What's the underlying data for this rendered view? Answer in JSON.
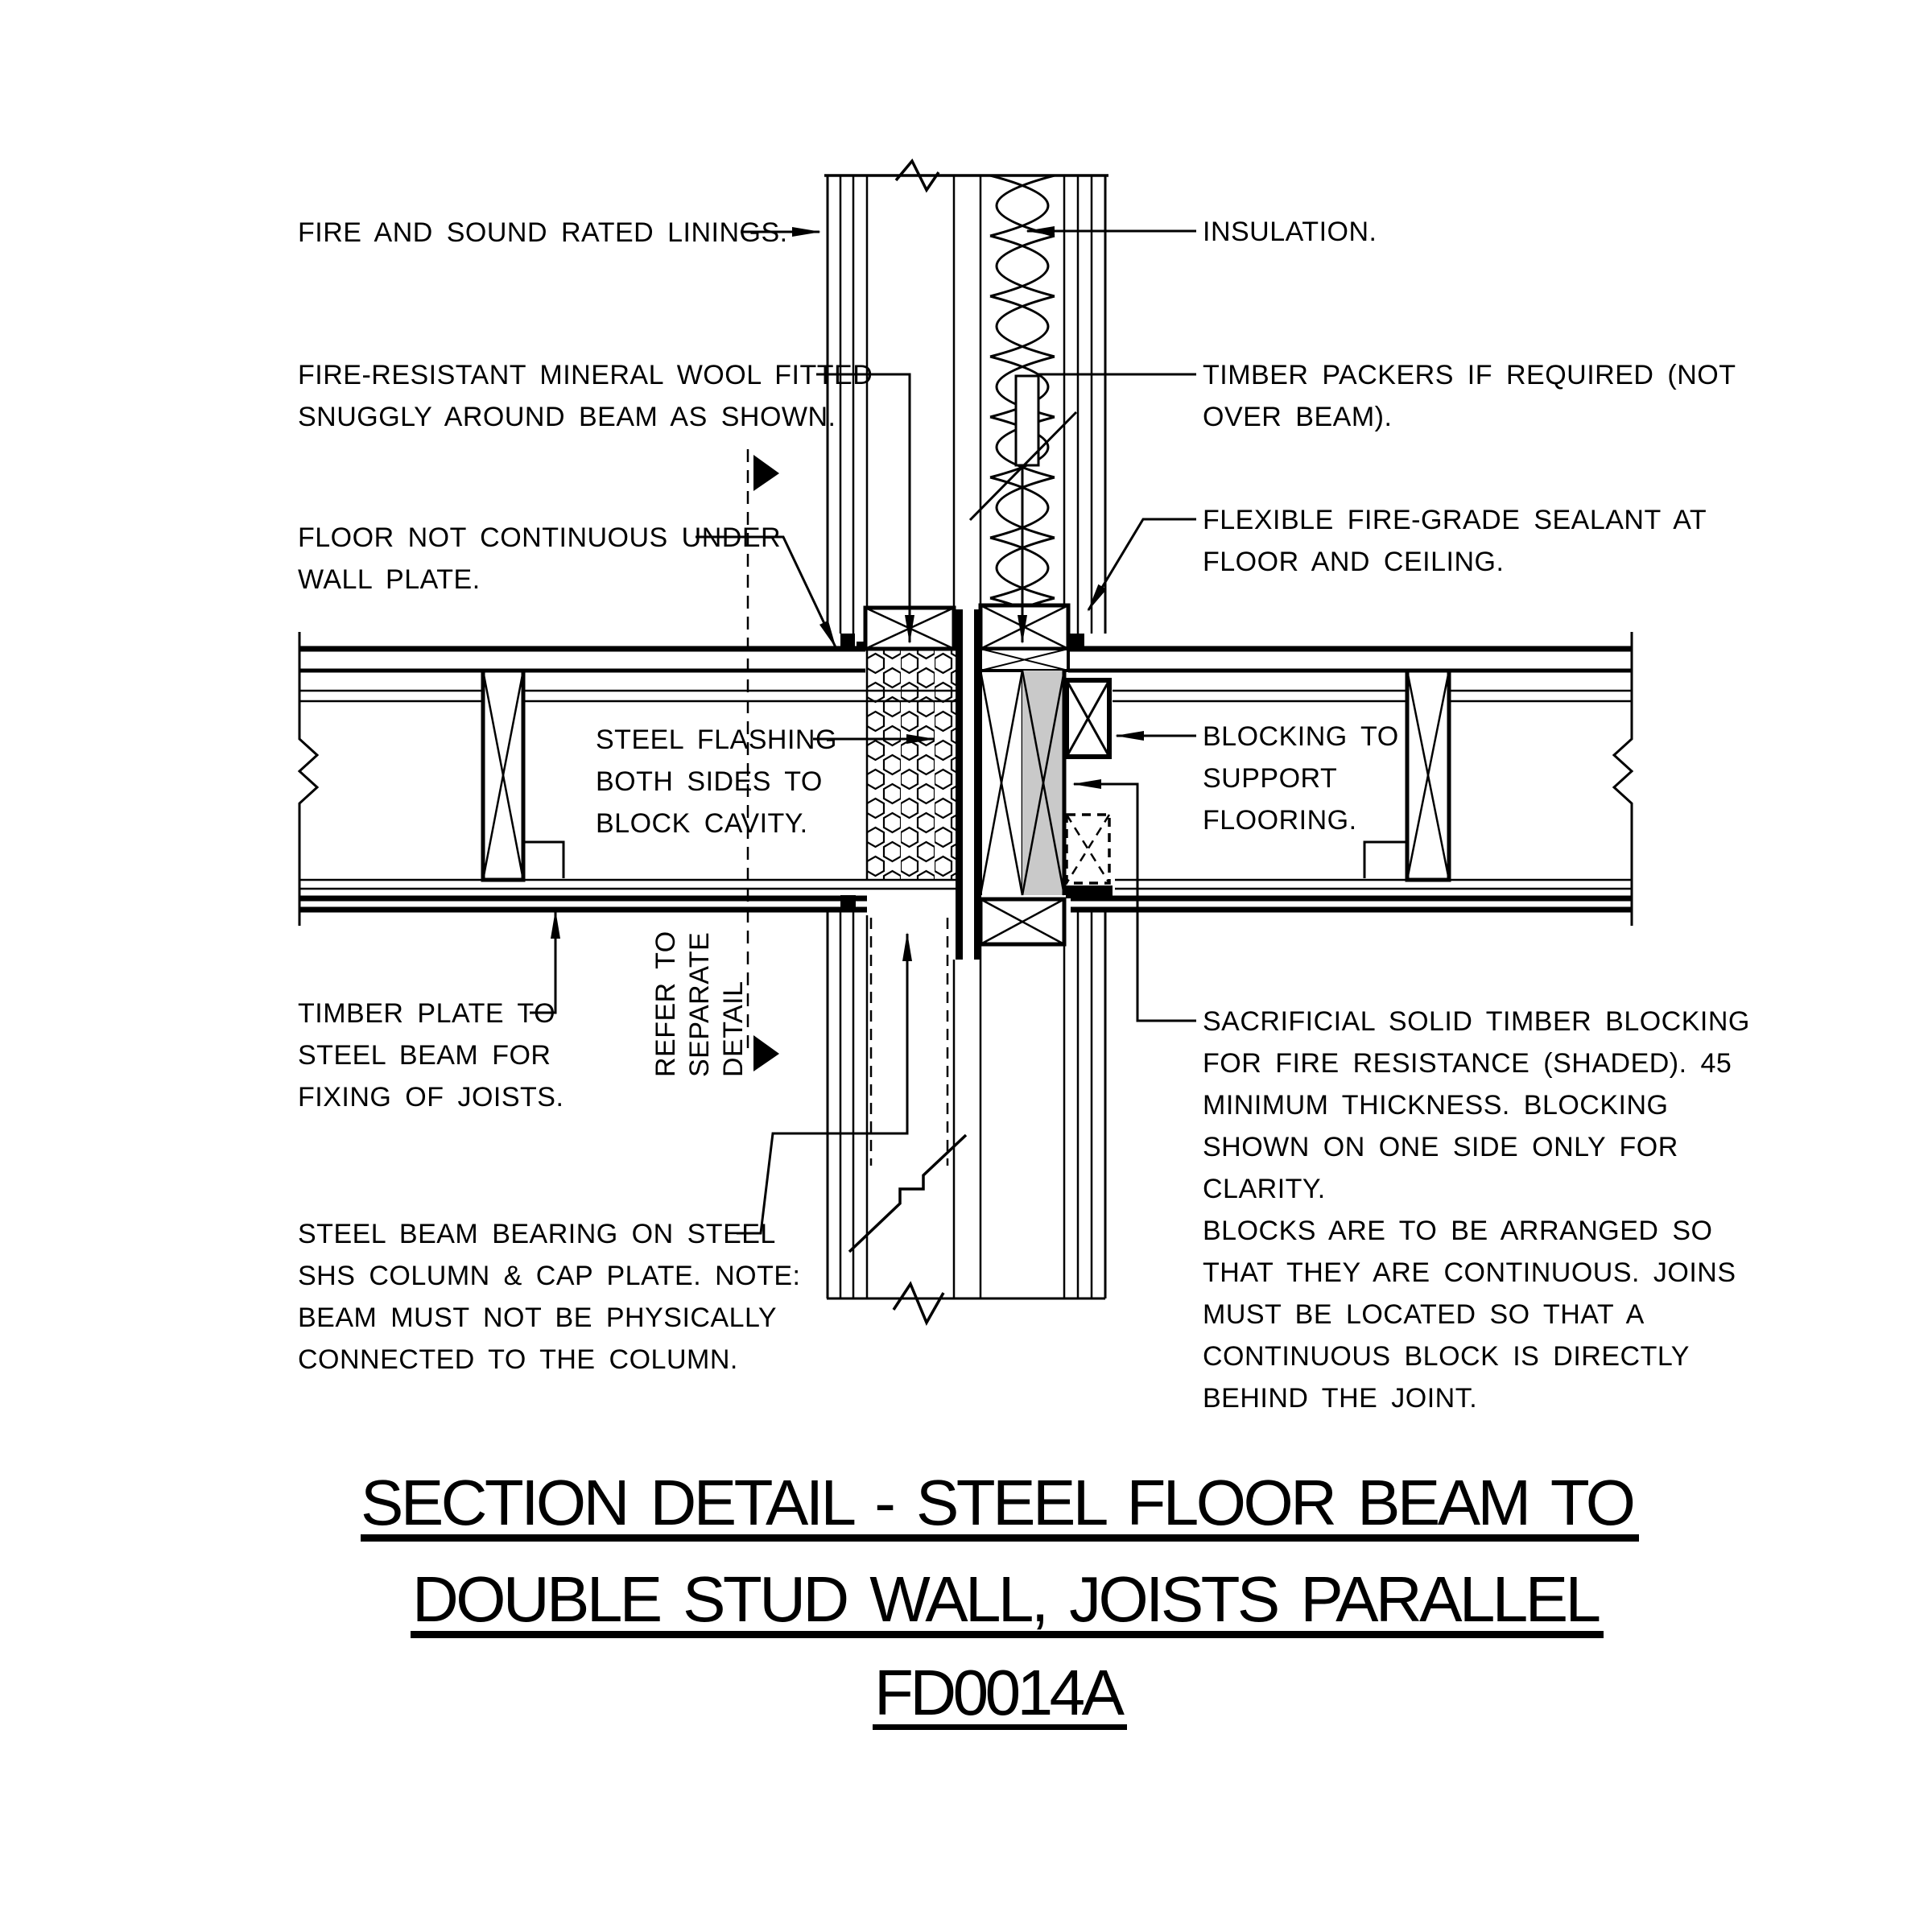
{
  "drawing": {
    "type": "construction-section-detail",
    "code": "FD0014A"
  },
  "title": {
    "line1": "SECTION DETAIL - STEEL FLOOR BEAM TO",
    "line2": "DOUBLE STUD WALL, JOISTS PARALLEL",
    "code": "FD0014A"
  },
  "labels": {
    "linings": {
      "lines": [
        "FIRE AND SOUND RATED LININGS."
      ]
    },
    "insulation": {
      "lines": [
        "INSULATION."
      ]
    },
    "mineral_wool": {
      "lines": [
        "FIRE-RESISTANT MINERAL WOOL FITTED",
        "SNUGGLY AROUND BEAM AS SHOWN."
      ]
    },
    "timber_packers": {
      "lines": [
        "TIMBER PACKERS IF REQUIRED (NOT",
        "OVER BEAM)."
      ]
    },
    "floor_not_continuous": {
      "lines": [
        "FLOOR NOT CONTINUOUS UNDER",
        "WALL PLATE."
      ]
    },
    "sealant": {
      "lines": [
        "FLEXIBLE FIRE-GRADE SEALANT AT",
        "FLOOR AND CEILING."
      ]
    },
    "steel_flashing": {
      "lines": [
        "STEEL FLASHING",
        "BOTH SIDES TO",
        "BLOCK CAVITY."
      ]
    },
    "blocking_support": {
      "lines": [
        "BLOCKING TO",
        "SUPPORT",
        "FLOORING."
      ]
    },
    "timber_plate": {
      "lines": [
        "TIMBER PLATE TO",
        "STEEL BEAM FOR",
        "FIXING OF JOISTS."
      ]
    },
    "refer_detail": {
      "lines": [
        "REFER TO",
        "SEPARATE",
        "DETAIL"
      ]
    },
    "steel_beam": {
      "lines": [
        "STEEL BEAM BEARING ON STEEL",
        "SHS COLUMN & CAP PLATE. NOTE:",
        "BEAM MUST NOT BE PHYSICALLY",
        "CONNECTED TO THE COLUMN."
      ]
    },
    "sacrificial": {
      "lines": [
        "SACRIFICIAL SOLID TIMBER BLOCKING",
        "FOR FIRE RESISTANCE (SHADED). 45",
        "MINIMUM THICKNESS. BLOCKING",
        "SHOWN ON ONE SIDE ONLY FOR",
        "CLARITY.",
        "BLOCKS ARE TO BE ARRANGED SO",
        "THAT THEY ARE CONTINUOUS. JOINS",
        "MUST BE LOCATED SO THAT A",
        "CONTINUOUS BLOCK IS DIRECTLY",
        "BEHIND THE JOINT."
      ]
    }
  },
  "colors": {
    "ink": "#000000",
    "paper": "#ffffff",
    "shaded_blocking": "#c9c9c9"
  }
}
